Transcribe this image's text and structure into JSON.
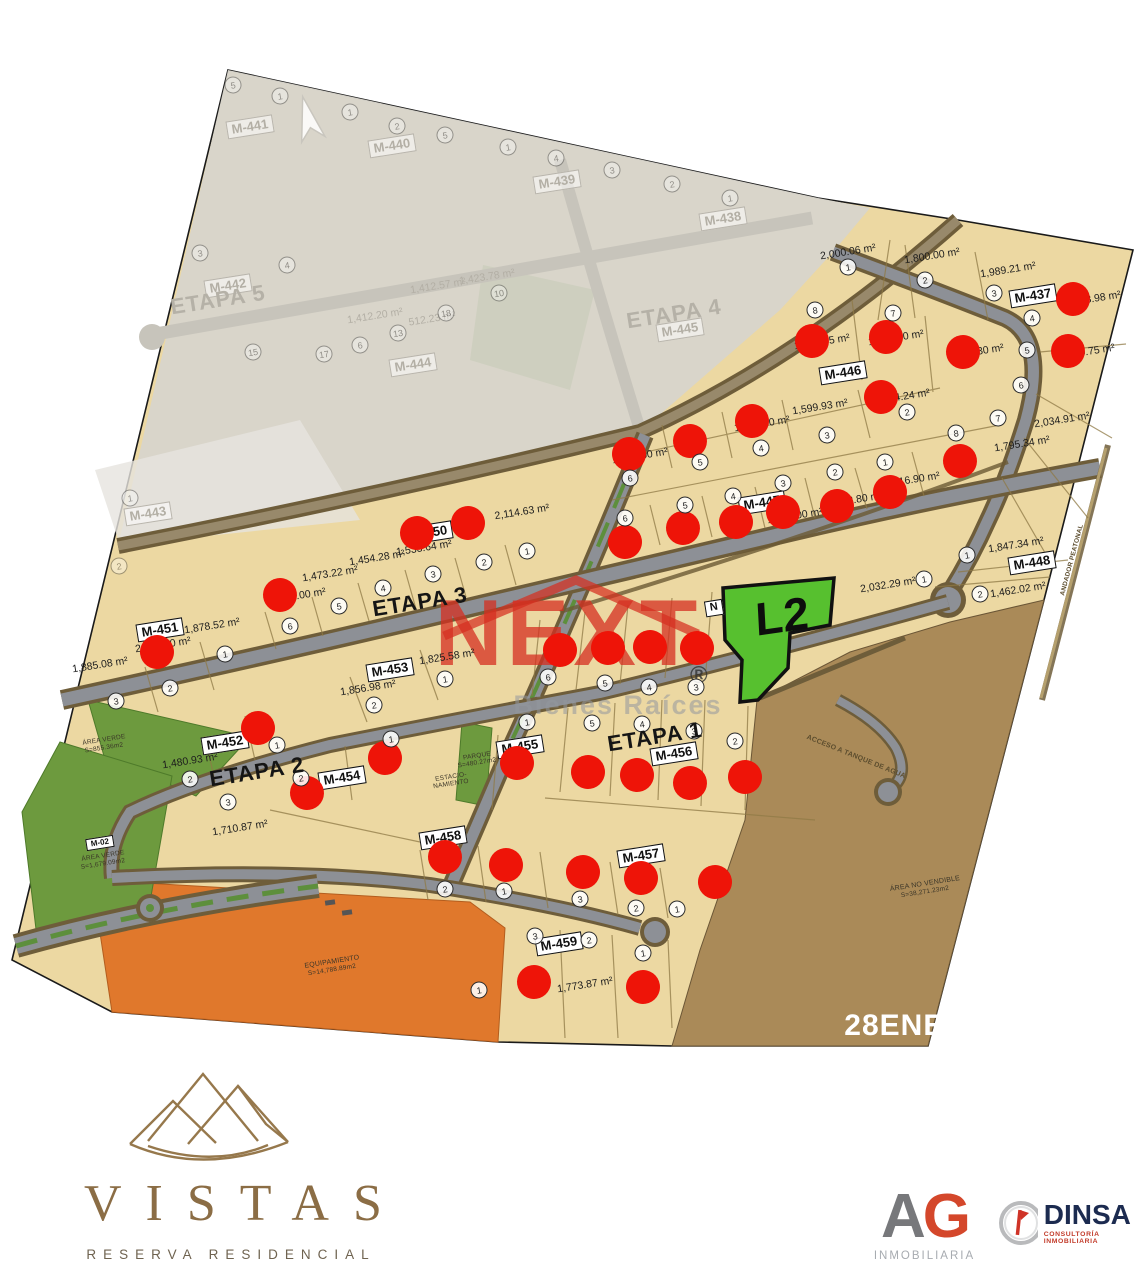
{
  "colors": {
    "sold": "#ee1408",
    "highlight_green": "#57c02f",
    "next_red": "#d5301f",
    "brand_gold": "#8b6d45",
    "dinsa_navy": "#1c2b50",
    "ag_red": "#d4472b",
    "ag_gray": "#77787b"
  },
  "map": {
    "date_stamp": "28ENE26",
    "highlight_lot": {
      "label": "L2"
    },
    "etapa_labels": [
      {
        "t": "ETAPA 1",
        "x": 655,
        "y": 737,
        "faded": false
      },
      {
        "t": "ETAPA 2",
        "x": 257,
        "y": 772,
        "faded": false
      },
      {
        "t": "ETAPA 3",
        "x": 420,
        "y": 602,
        "faded": false
      },
      {
        "t": "ETAPA 4",
        "x": 674,
        "y": 314,
        "faded": true
      },
      {
        "t": "ETAPA 5",
        "x": 218,
        "y": 300,
        "faded": true
      }
    ],
    "block_labels": [
      {
        "t": "M-437",
        "x": 1033,
        "y": 296
      },
      {
        "t": "M-446",
        "x": 843,
        "y": 373
      },
      {
        "t": "M-447",
        "x": 762,
        "y": 503
      },
      {
        "t": "M-448",
        "x": 1032,
        "y": 563
      },
      {
        "t": "M-450",
        "x": 429,
        "y": 533
      },
      {
        "t": "M-451",
        "x": 160,
        "y": 630
      },
      {
        "t": "M-452",
        "x": 225,
        "y": 743
      },
      {
        "t": "M-453",
        "x": 390,
        "y": 670
      },
      {
        "t": "M-454",
        "x": 342,
        "y": 778
      },
      {
        "t": "M-455",
        "x": 520,
        "y": 747
      },
      {
        "t": "M-456",
        "x": 674,
        "y": 754
      },
      {
        "t": "M-457",
        "x": 641,
        "y": 856
      },
      {
        "t": "M-458",
        "x": 443,
        "y": 838
      },
      {
        "t": "M-459",
        "x": 559,
        "y": 944
      },
      {
        "t": "N",
        "x": 714,
        "y": 608,
        "fs": 11
      },
      {
        "t": "M-02",
        "x": 100,
        "y": 843,
        "fs": 8
      }
    ],
    "block_labels_faded": [
      {
        "t": "M-441",
        "x": 250,
        "y": 127
      },
      {
        "t": "M-440",
        "x": 392,
        "y": 146
      },
      {
        "t": "M-439",
        "x": 557,
        "y": 182
      },
      {
        "t": "M-438",
        "x": 723,
        "y": 219
      },
      {
        "t": "M-442",
        "x": 228,
        "y": 286
      },
      {
        "t": "M-445",
        "x": 680,
        "y": 330
      },
      {
        "t": "M-444",
        "x": 413,
        "y": 365
      },
      {
        "t": "M-443",
        "x": 148,
        "y": 514
      }
    ],
    "area_labels": [
      {
        "t": "2,000.06 m²",
        "x": 848,
        "y": 252
      },
      {
        "t": "1,800.00 m²",
        "x": 932,
        "y": 256
      },
      {
        "t": "1,989.21 m²",
        "x": 1008,
        "y": 270
      },
      {
        "t": "2,158.98 m²",
        "x": 1093,
        "y": 299
      },
      {
        "t": "1,740.75 m²",
        "x": 1087,
        "y": 352
      },
      {
        "t": "2,034.91 m²",
        "x": 1062,
        "y": 420
      },
      {
        "t": "1,795.34 m²",
        "x": 1022,
        "y": 444
      },
      {
        "t": "1,745.85 m²",
        "x": 822,
        "y": 342
      },
      {
        "t": "1,752.40 m²",
        "x": 896,
        "y": 338
      },
      {
        "t": "1,746.30 m²",
        "x": 976,
        "y": 352
      },
      {
        "t": "1,599.93 m²",
        "x": 820,
        "y": 407
      },
      {
        "t": "1,534.24 m²",
        "x": 902,
        "y": 397
      },
      {
        "t": "1,437.50 m²",
        "x": 762,
        "y": 424
      },
      {
        "t": "1,256.50 m²",
        "x": 640,
        "y": 456
      },
      {
        "t": "1,416.90 m²",
        "x": 912,
        "y": 480
      },
      {
        "t": "1,342.80 m²",
        "x": 855,
        "y": 500
      },
      {
        "t": "1,530.00 m²",
        "x": 795,
        "y": 516
      },
      {
        "t": "2,032.29 m²",
        "x": 888,
        "y": 585
      },
      {
        "t": "1,847.34 m²",
        "x": 1016,
        "y": 545
      },
      {
        "t": "1,462.02 m²",
        "x": 1018,
        "y": 590
      },
      {
        "t": "2,114.63 m²",
        "x": 522,
        "y": 512
      },
      {
        "t": "1,533.64 m²",
        "x": 424,
        "y": 548
      },
      {
        "t": "1,454.28 m²",
        "x": 377,
        "y": 558
      },
      {
        "t": "1,473.22 m²",
        "x": 330,
        "y": 574
      },
      {
        "t": "1,878.52 m²",
        "x": 212,
        "y": 626
      },
      {
        "t": "2,433.90 m²",
        "x": 163,
        "y": 645
      },
      {
        "t": "1,885.08 m²",
        "x": 100,
        "y": 665
      },
      {
        "t": "1,825.58 m²",
        "x": 447,
        "y": 657
      },
      {
        "t": "1,856.98 m²",
        "x": 368,
        "y": 688
      },
      {
        "t": "1,545.00 m²",
        "x": 298,
        "y": 596
      },
      {
        "t": "1,480.93 m²",
        "x": 190,
        "y": 761
      },
      {
        "t": "1,710.87 m²",
        "x": 240,
        "y": 828
      },
      {
        "t": "1,773.87 m²",
        "x": 585,
        "y": 985
      }
    ],
    "area_labels_faded": [
      {
        "t": "1,423.78 m²",
        "x": 487,
        "y": 277
      },
      {
        "t": "1,412.57 m²",
        "x": 438,
        "y": 286
      },
      {
        "t": "1,412.20 m²",
        "x": 375,
        "y": 316
      },
      {
        "t": "512.23 m²",
        "x": 432,
        "y": 319
      }
    ],
    "lot_circles": [
      {
        "n": "1",
        "x": 848,
        "y": 267
      },
      {
        "n": "2",
        "x": 925,
        "y": 280
      },
      {
        "n": "3",
        "x": 994,
        "y": 293
      },
      {
        "n": "4",
        "x": 1032,
        "y": 318
      },
      {
        "n": "5",
        "x": 1027,
        "y": 350
      },
      {
        "n": "6",
        "x": 1021,
        "y": 385
      },
      {
        "n": "7",
        "x": 998,
        "y": 418
      },
      {
        "n": "8",
        "x": 956,
        "y": 433
      },
      {
        "n": "8",
        "x": 815,
        "y": 310
      },
      {
        "n": "7",
        "x": 893,
        "y": 313
      },
      {
        "n": "2",
        "x": 907,
        "y": 412
      },
      {
        "n": "3",
        "x": 827,
        "y": 435
      },
      {
        "n": "4",
        "x": 761,
        "y": 448
      },
      {
        "n": "5",
        "x": 700,
        "y": 462
      },
      {
        "n": "6",
        "x": 630,
        "y": 478
      },
      {
        "n": "1",
        "x": 885,
        "y": 462
      },
      {
        "n": "2",
        "x": 835,
        "y": 472
      },
      {
        "n": "3",
        "x": 783,
        "y": 483
      },
      {
        "n": "4",
        "x": 733,
        "y": 496
      },
      {
        "n": "5",
        "x": 685,
        "y": 505
      },
      {
        "n": "6",
        "x": 625,
        "y": 518
      },
      {
        "n": "1",
        "x": 924,
        "y": 579
      },
      {
        "n": "1",
        "x": 967,
        "y": 555
      },
      {
        "n": "2",
        "x": 980,
        "y": 594
      },
      {
        "n": "1",
        "x": 527,
        "y": 551
      },
      {
        "n": "2",
        "x": 484,
        "y": 562
      },
      {
        "n": "3",
        "x": 433,
        "y": 574
      },
      {
        "n": "4",
        "x": 383,
        "y": 588
      },
      {
        "n": "5",
        "x": 339,
        "y": 606
      },
      {
        "n": "6",
        "x": 290,
        "y": 626
      },
      {
        "n": "1",
        "x": 225,
        "y": 654
      },
      {
        "n": "2",
        "x": 170,
        "y": 688
      },
      {
        "n": "3",
        "x": 116,
        "y": 701
      },
      {
        "n": "1",
        "x": 445,
        "y": 679
      },
      {
        "n": "2",
        "x": 374,
        "y": 705
      },
      {
        "n": "6",
        "x": 548,
        "y": 677
      },
      {
        "n": "5",
        "x": 605,
        "y": 683
      },
      {
        "n": "4",
        "x": 649,
        "y": 687
      },
      {
        "n": "3",
        "x": 696,
        "y": 687
      },
      {
        "n": "1",
        "x": 277,
        "y": 745
      },
      {
        "n": "2",
        "x": 190,
        "y": 779
      },
      {
        "n": "3",
        "x": 228,
        "y": 802
      },
      {
        "n": "1",
        "x": 391,
        "y": 739
      },
      {
        "n": "2",
        "x": 301,
        "y": 778
      },
      {
        "n": "1",
        "x": 527,
        "y": 722
      },
      {
        "n": "5",
        "x": 592,
        "y": 723
      },
      {
        "n": "4",
        "x": 642,
        "y": 724
      },
      {
        "n": "3",
        "x": 694,
        "y": 731
      },
      {
        "n": "2",
        "x": 735,
        "y": 741
      },
      {
        "n": "2",
        "x": 445,
        "y": 889
      },
      {
        "n": "1",
        "x": 504,
        "y": 891
      },
      {
        "n": "3",
        "x": 580,
        "y": 899
      },
      {
        "n": "2",
        "x": 636,
        "y": 908
      },
      {
        "n": "1",
        "x": 677,
        "y": 909
      },
      {
        "n": "3",
        "x": 535,
        "y": 936
      },
      {
        "n": "2",
        "x": 589,
        "y": 940
      },
      {
        "n": "1",
        "x": 643,
        "y": 953
      },
      {
        "n": "1",
        "x": 479,
        "y": 990
      }
    ],
    "lot_circles_faded": [
      {
        "n": "5",
        "x": 233,
        "y": 85
      },
      {
        "n": "1",
        "x": 280,
        "y": 96
      },
      {
        "n": "1",
        "x": 350,
        "y": 112
      },
      {
        "n": "2",
        "x": 397,
        "y": 126
      },
      {
        "n": "5",
        "x": 445,
        "y": 135
      },
      {
        "n": "1",
        "x": 508,
        "y": 147
      },
      {
        "n": "4",
        "x": 556,
        "y": 158
      },
      {
        "n": "3",
        "x": 612,
        "y": 170
      },
      {
        "n": "2",
        "x": 672,
        "y": 184
      },
      {
        "n": "1",
        "x": 730,
        "y": 198
      },
      {
        "n": "10",
        "x": 499,
        "y": 293
      },
      {
        "n": "18",
        "x": 446,
        "y": 313
      },
      {
        "n": "13",
        "x": 398,
        "y": 333
      },
      {
        "n": "6",
        "x": 360,
        "y": 345
      },
      {
        "n": "17",
        "x": 324,
        "y": 354
      },
      {
        "n": "15",
        "x": 253,
        "y": 352
      },
      {
        "n": "4",
        "x": 287,
        "y": 265
      },
      {
        "n": "3",
        "x": 200,
        "y": 253
      },
      {
        "n": "1",
        "x": 130,
        "y": 498
      },
      {
        "n": "2",
        "x": 119,
        "y": 566
      }
    ],
    "sold_dots": [
      [
        812,
        341
      ],
      [
        886,
        337
      ],
      [
        963,
        352
      ],
      [
        1073,
        299
      ],
      [
        1068,
        351
      ],
      [
        881,
        397
      ],
      [
        752,
        421
      ],
      [
        690,
        441
      ],
      [
        629,
        454
      ],
      [
        960,
        461
      ],
      [
        890,
        492
      ],
      [
        837,
        506
      ],
      [
        783,
        512
      ],
      [
        736,
        522
      ],
      [
        683,
        528
      ],
      [
        625,
        542
      ],
      [
        468,
        523
      ],
      [
        417,
        533
      ],
      [
        280,
        595
      ],
      [
        157,
        652
      ],
      [
        560,
        650
      ],
      [
        608,
        648
      ],
      [
        650,
        647
      ],
      [
        697,
        648
      ],
      [
        258,
        728
      ],
      [
        385,
        758
      ],
      [
        307,
        793
      ],
      [
        517,
        763
      ],
      [
        588,
        772
      ],
      [
        637,
        775
      ],
      [
        690,
        783
      ],
      [
        745,
        777
      ],
      [
        445,
        857
      ],
      [
        506,
        865
      ],
      [
        583,
        872
      ],
      [
        641,
        878
      ],
      [
        715,
        882
      ],
      [
        534,
        982
      ],
      [
        643,
        987
      ]
    ],
    "misc_labels": [
      {
        "t": "ÁREA VERDE",
        "x": 104,
        "y": 740
      },
      {
        "t": "S=855.36m2",
        "x": 104,
        "y": 748
      },
      {
        "t": "ÁREA VERDE",
        "x": 103,
        "y": 856
      },
      {
        "t": "S=1,679.09m2",
        "x": 103,
        "y": 864
      },
      {
        "t": "PARQUE",
        "x": 477,
        "y": 756
      },
      {
        "t": "S=480.27m2",
        "x": 477,
        "y": 763
      },
      {
        "t": "ESTACIO-",
        "x": 451,
        "y": 777
      },
      {
        "t": "NAMIENTO",
        "x": 451,
        "y": 784
      },
      {
        "t": "EQUIPAMIENTO",
        "x": 332,
        "y": 962,
        "fs": 7
      },
      {
        "t": "S=14,788.89m2",
        "x": 332,
        "y": 970
      },
      {
        "t": "ÁREA NO VENDIBLE",
        "x": 925,
        "y": 884,
        "fs": 7
      },
      {
        "t": "S=38,271.23m2",
        "x": 925,
        "y": 892
      },
      {
        "t": "ACCESO A TANQUE DE AGUA",
        "x": 856,
        "y": 757,
        "r": 22,
        "fs": 7,
        "road": true
      },
      {
        "t": "ANDADOR PEATONAL",
        "x": 1072,
        "y": 560,
        "r": -75,
        "fs": 6.5,
        "road": true
      }
    ]
  },
  "watermark": {
    "brand": "NEXT",
    "registered": "®",
    "subtitle": "Bienes Raíces"
  },
  "footer": {
    "vistas": {
      "name": "VISTAS",
      "tagline": "RESERVA RESIDENCIAL"
    },
    "ag": {
      "letter_a": "A",
      "letter_g": "G",
      "subtitle": "INMOBILIARIA"
    },
    "dinsa": {
      "name": "DINSA",
      "subtitle": "CONSULTORÍA INMOBILIARIA"
    }
  }
}
